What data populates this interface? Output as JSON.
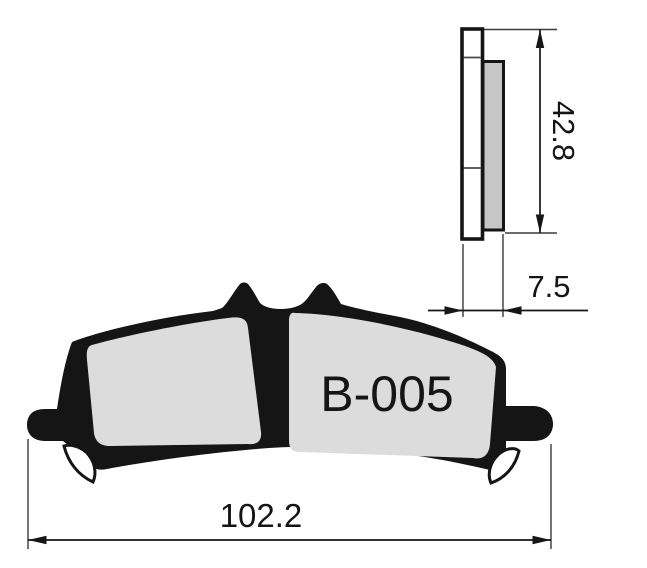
{
  "drawing": {
    "part_label": "B-005",
    "dimensions": {
      "height": "42.8",
      "thickness": "7.5",
      "length": "102.2"
    },
    "colors": {
      "line": "#151515",
      "backing_fill": "#ffffff",
      "friction_fill": "#c6c6c6",
      "pad_fill": "#dcdcdc",
      "background": "#ffffff"
    }
  }
}
